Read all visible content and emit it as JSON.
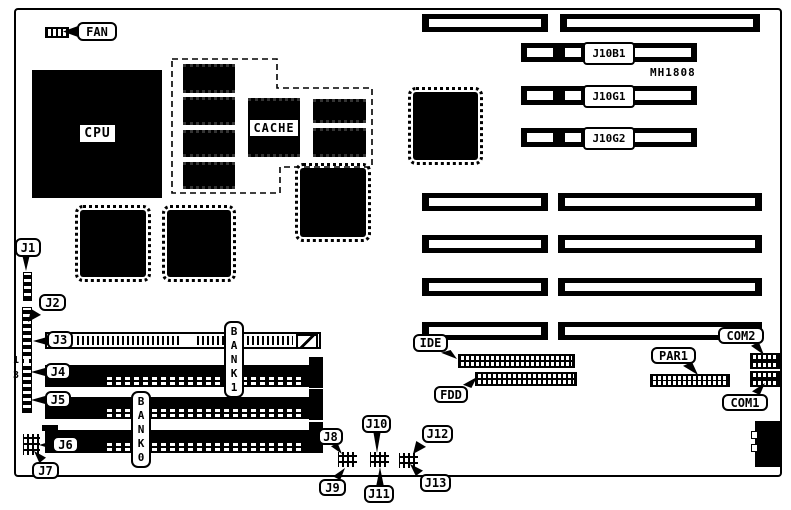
{
  "diagram": {
    "type": "motherboard-layout",
    "board_id": "MH1808",
    "colors": {
      "ink": "#000000",
      "background": "#ffffff"
    },
    "fan": {
      "label": "FAN"
    },
    "processor": {
      "cpu_label": "CPU",
      "cache_label": "CACHE"
    },
    "memory": {
      "bank0_label": "BANK0",
      "bank1_label": "BANK1",
      "pin_marker_1": "1",
      "pin_marker_3": "3"
    },
    "slots": {
      "j10b1": "J10B1",
      "j10g1": "J10G1",
      "j10g2": "J10G2"
    },
    "connectors": {
      "ide": "IDE",
      "fdd": "FDD",
      "par1": "PAR1",
      "com1": "COM1",
      "com2": "COM2"
    },
    "jumpers": {
      "j1": "J1",
      "j2": "J2",
      "j3": "J3",
      "j4": "J4",
      "j5": "J5",
      "j6": "J6",
      "j7": "J7",
      "j8": "J8",
      "j9": "J9",
      "j10": "J10",
      "j11": "J11",
      "j12": "J12",
      "j13": "J13"
    }
  }
}
